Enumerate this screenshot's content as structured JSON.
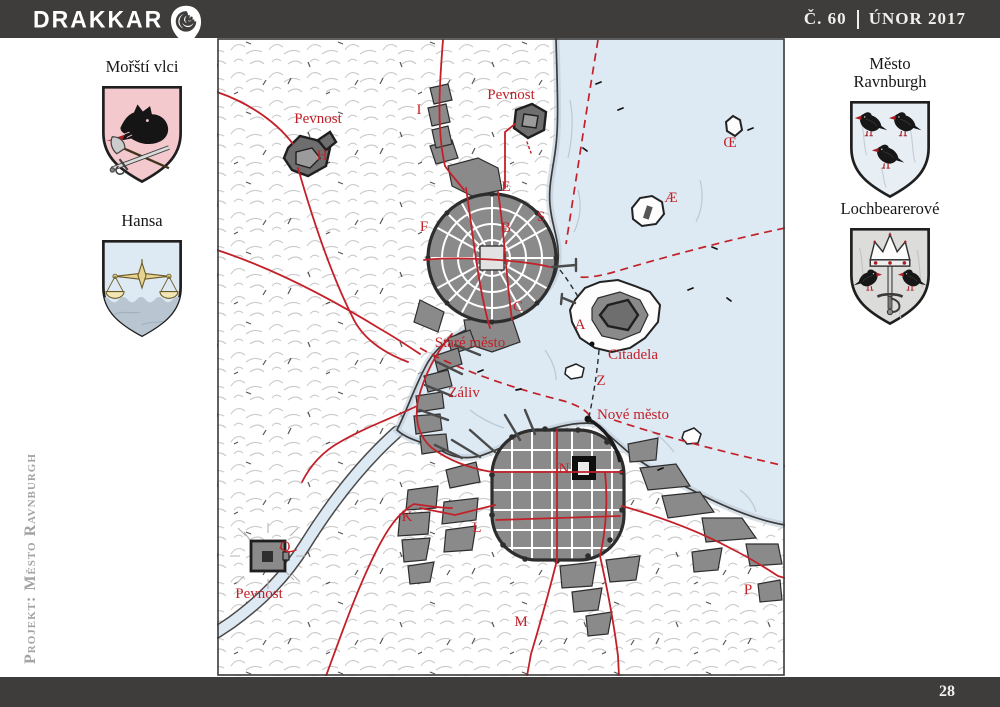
{
  "colors": {
    "bar": "#3e3d3c",
    "accent_red": "#c32129",
    "sea": "#dde9f3",
    "city_gray": "#8a8a8a"
  },
  "header": {
    "magazine_title": "DRAKKAR",
    "issue_number": "Č. 60",
    "issue_date": "ÚNOR 2017"
  },
  "footer": {
    "page_number": "28"
  },
  "margin_note": {
    "project_label": "Projekt: Město Ravnburgh"
  },
  "heraldry": {
    "left": [
      {
        "title": "Mořští vlci",
        "field_color": "#f3c9cd"
      },
      {
        "title": "Hansa",
        "field_color": "#dde9f3"
      }
    ],
    "right": [
      {
        "title": "Město Ravnburgh",
        "field_color": "#e7eef4"
      },
      {
        "title": "Lochbearerové",
        "field_color": "#dcdcda"
      }
    ]
  },
  "map": {
    "labels": [
      {
        "id": "pevnost-west",
        "text": "Pevnost",
        "x": 318,
        "y": 123
      },
      {
        "id": "h",
        "text": "H",
        "x": 322,
        "y": 160
      },
      {
        "id": "i",
        "text": "I",
        "x": 419,
        "y": 114
      },
      {
        "id": "pevnost-north",
        "text": "Pevnost",
        "x": 511,
        "y": 99
      },
      {
        "id": "e",
        "text": "E",
        "x": 506,
        "y": 191
      },
      {
        "id": "s",
        "text": "S",
        "x": 541,
        "y": 221
      },
      {
        "id": "b",
        "text": "B",
        "x": 506,
        "y": 232
      },
      {
        "id": "f",
        "text": "F",
        "x": 424,
        "y": 231
      },
      {
        "id": "c",
        "text": "C",
        "x": 518,
        "y": 311
      },
      {
        "id": "a",
        "text": "A",
        "x": 580,
        "y": 329
      },
      {
        "id": "ae",
        "text": "Æ",
        "x": 671,
        "y": 202
      },
      {
        "id": "oe",
        "text": "Œ",
        "x": 730,
        "y": 147
      },
      {
        "id": "stare-mesto",
        "text": "Staré město",
        "x": 470,
        "y": 347
      },
      {
        "id": "citadela",
        "text": "Citadela",
        "x": 633,
        "y": 359
      },
      {
        "id": "zaliv",
        "text": "Záliv",
        "x": 464,
        "y": 397
      },
      {
        "id": "z",
        "text": "Z",
        "x": 601,
        "y": 385
      },
      {
        "id": "nove-mesto",
        "text": "Nové město",
        "x": 633,
        "y": 419
      },
      {
        "id": "n",
        "text": "N",
        "x": 564,
        "y": 473
      },
      {
        "id": "k",
        "text": "K",
        "x": 407,
        "y": 521
      },
      {
        "id": "l",
        "text": "L",
        "x": 477,
        "y": 532
      },
      {
        "id": "q",
        "text": "Q",
        "x": 285,
        "y": 551
      },
      {
        "id": "pevnost-south",
        "text": "Pevnost",
        "x": 259,
        "y": 598
      },
      {
        "id": "m",
        "text": "M",
        "x": 521,
        "y": 626
      },
      {
        "id": "p",
        "text": "P",
        "x": 748,
        "y": 594
      }
    ]
  }
}
